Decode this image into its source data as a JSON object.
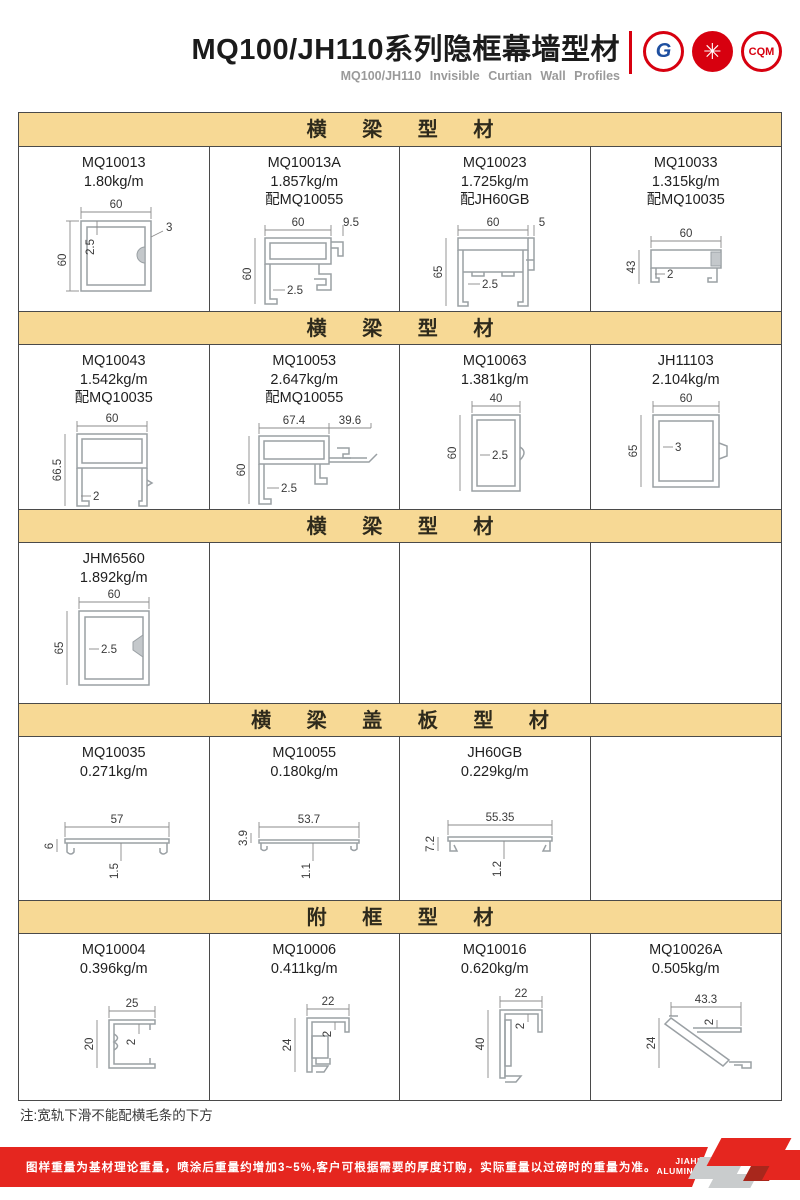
{
  "header": {
    "title": "MQ100/JH110系列隐框幕墙型材",
    "subtitle": "MQ100/JH110 Invisible Curtian Wall Profiles",
    "logos": [
      {
        "name": "gb-certification",
        "glyph": "G"
      },
      {
        "name": "quality-emblem",
        "glyph": "✳"
      },
      {
        "name": "cqm-certification",
        "glyph": "CQM"
      }
    ]
  },
  "sections": [
    {
      "title": "横 梁 型 材",
      "cells": [
        {
          "model": "MQ10013",
          "weight": "1.80kg/m",
          "dims": {
            "top": "60",
            "left": "60",
            "wall": "2.5",
            "extra": "3"
          }
        },
        {
          "model": "MQ10013A",
          "weight": "1.857kg/m",
          "match": "配MQ10055",
          "dims": {
            "top": "60",
            "top2": "9.5",
            "left": "60",
            "wall": "2.5"
          }
        },
        {
          "model": "MQ10023",
          "weight": "1.725kg/m",
          "match": "配JH60GB",
          "dims": {
            "top": "60",
            "top2": "5",
            "left": "65",
            "wall": "2.5"
          }
        },
        {
          "model": "MQ10033",
          "weight": "1.315kg/m",
          "match": "配MQ10035",
          "dims": {
            "top": "60",
            "left": "43",
            "wall": "2"
          }
        }
      ]
    },
    {
      "title": "横 梁 型 材",
      "cells": [
        {
          "model": "MQ10043",
          "weight": "1.542kg/m",
          "match": "配MQ10035",
          "dims": {
            "top": "60",
            "left": "66.5",
            "wall": "2"
          }
        },
        {
          "model": "MQ10053",
          "weight": "2.647kg/m",
          "match": "配MQ10055",
          "dims": {
            "top": "67.4",
            "top2": "39.6",
            "left": "60",
            "wall": "2.5"
          }
        },
        {
          "model": "MQ10063",
          "weight": "1.381kg/m",
          "dims": {
            "top": "40",
            "left": "60",
            "wall": "2.5"
          }
        },
        {
          "model": "JH11103",
          "weight": "2.104kg/m",
          "dims": {
            "top": "60",
            "left": "65",
            "wall": "3"
          }
        }
      ]
    },
    {
      "title": "横 梁 型 材",
      "cells": [
        {
          "model": "JHM6560",
          "weight": "1.892kg/m",
          "dims": {
            "top": "60",
            "left": "65",
            "wall": "2.5"
          }
        }
      ]
    },
    {
      "title": "横 梁 盖 板 型 材",
      "cells": [
        {
          "model": "MQ10035",
          "weight": "0.271kg/m",
          "dims": {
            "top": "57",
            "left": "6",
            "wall": "1.5"
          }
        },
        {
          "model": "MQ10055",
          "weight": "0.180kg/m",
          "dims": {
            "top": "53.7",
            "left": "3.9",
            "wall": "1.1"
          }
        },
        {
          "model": "JH60GB",
          "weight": "0.229kg/m",
          "dims": {
            "top": "55.35",
            "left": "7.2",
            "wall": "1.2"
          }
        }
      ]
    },
    {
      "title": "附 框 型 材",
      "cells": [
        {
          "model": "MQ10004",
          "weight": "0.396kg/m",
          "dims": {
            "top": "25",
            "left": "20",
            "wall": "2"
          }
        },
        {
          "model": "MQ10006",
          "weight": "0.411kg/m",
          "dims": {
            "top": "22",
            "left": "24",
            "wall": "2"
          }
        },
        {
          "model": "MQ10016",
          "weight": "0.620kg/m",
          "dims": {
            "top": "22",
            "left": "40",
            "wall": "2"
          }
        },
        {
          "model": "MQ10026A",
          "weight": "0.505kg/m",
          "dims": {
            "top": "43.3",
            "left": "24",
            "wall": "2"
          }
        }
      ]
    }
  ],
  "note": "注:宽轨下滑不能配横毛条的下方",
  "footer": {
    "text": "图样重量为基材理论重量，喷涂后重量约增加3~5%,客户可根据需要的厚度订购，实际重量以过磅时的重量为准。",
    "brand_line1": "JIAHUA",
    "brand_line2": "ALUMINIUM",
    "page_number": "29"
  },
  "colors": {
    "section_header_bg": "#F7D995",
    "accent_red": "#E5261F",
    "logo_red": "#D7000F",
    "grid_line": "#4A4A4A"
  }
}
